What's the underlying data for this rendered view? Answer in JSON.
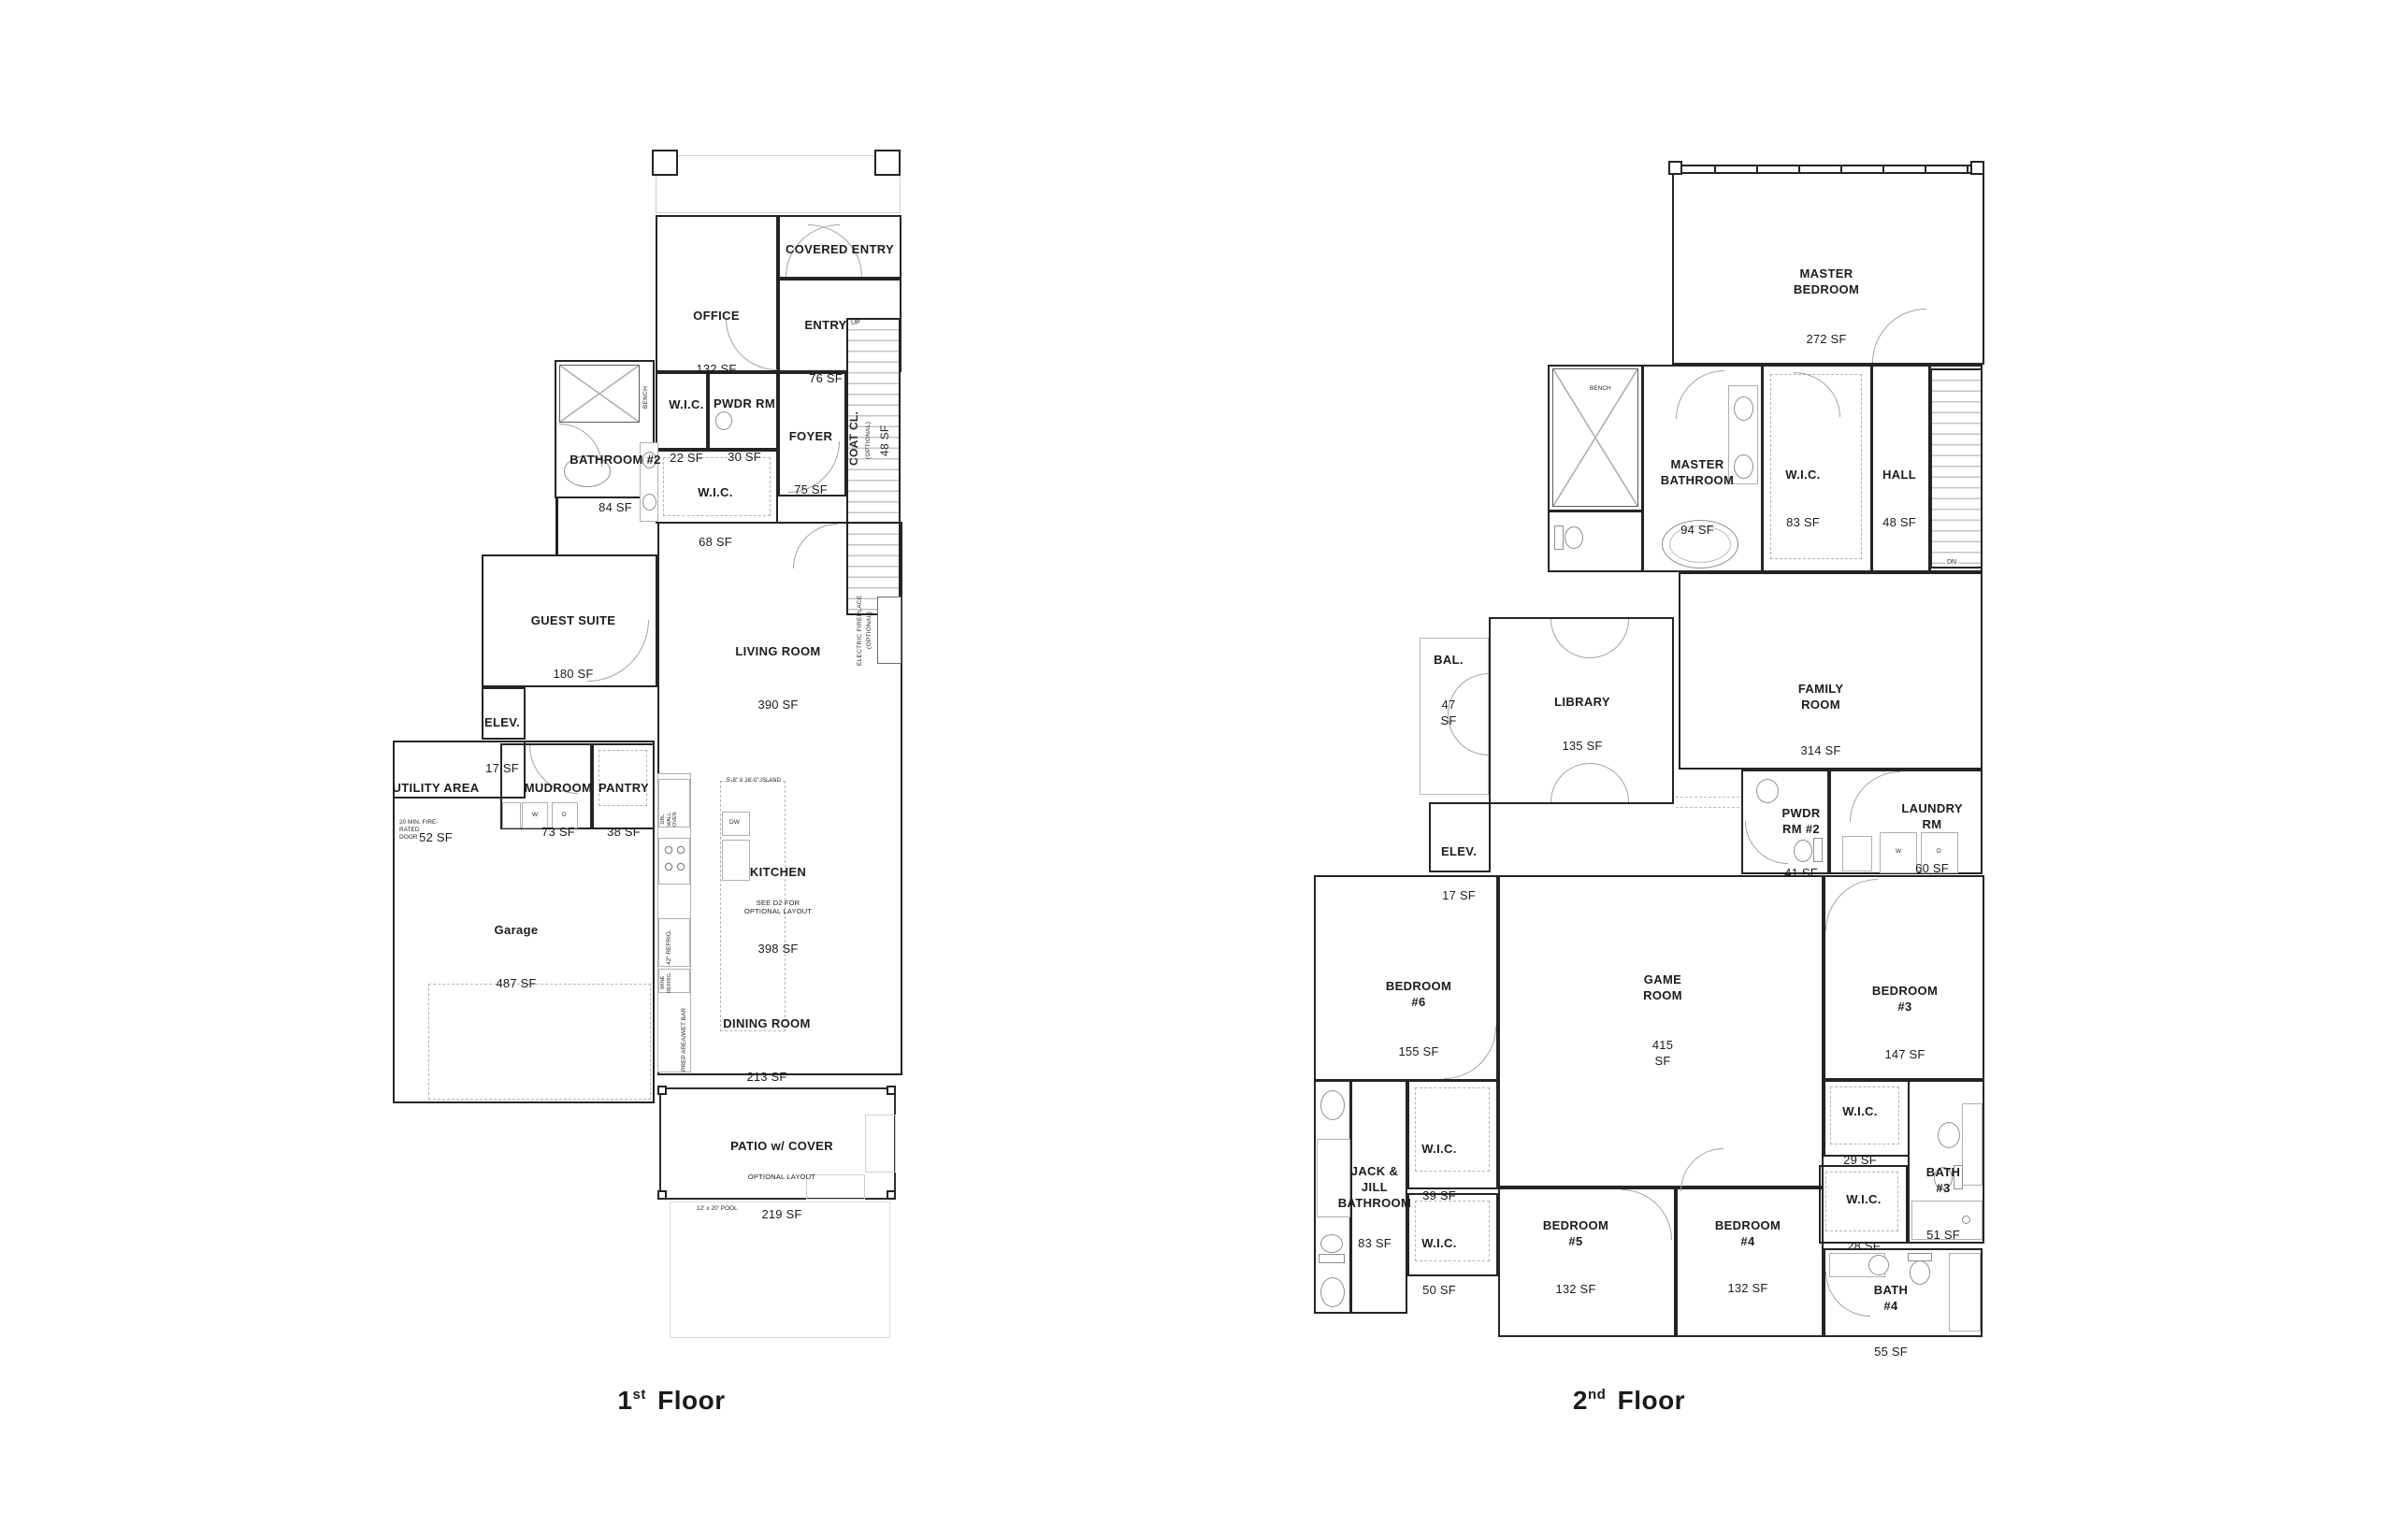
{
  "floors": {
    "first": {
      "title": {
        "num": "1",
        "sup": "st",
        "rest": "Floor"
      },
      "rooms": {
        "office": {
          "name": "OFFICE",
          "area": "132 SF"
        },
        "covered_entry": {
          "name": "COVERED ENTRY"
        },
        "entry": {
          "name": "ENTRY",
          "area": "76 SF"
        },
        "wic_entry": {
          "name": "W.I.C.",
          "area": "22 SF"
        },
        "pwdr": {
          "name": "PWDR RM",
          "area": "30 SF"
        },
        "foyer": {
          "name": "FOYER",
          "area": "75 SF"
        },
        "coat_closet": {
          "name": "COAT CL.",
          "sub": "(OPTIONAL)",
          "area": "48 SF"
        },
        "bathroom2": {
          "name": "BATHROOM #2",
          "area": "84 SF"
        },
        "wic_hall": {
          "name": "W.I.C.",
          "area": "68 SF"
        },
        "guest_suite": {
          "name": "GUEST SUITE",
          "area": "180 SF"
        },
        "living_room": {
          "name": "LIVING ROOM",
          "area": "390 SF"
        },
        "elevator": {
          "name": "ELEV.",
          "area": "17 SF"
        },
        "utility": {
          "name": "UTILITY AREA",
          "area": "52 SF",
          "note": "20 MIN. FIRE-\nRATED\nDOOR"
        },
        "mudroom": {
          "name": "MUDROOM",
          "area": "73 SF"
        },
        "pantry": {
          "name": "PANTRY",
          "area": "38 SF"
        },
        "garage": {
          "name": "Garage",
          "area": "487 SF"
        },
        "kitchen": {
          "name": "KITCHEN",
          "sub": "SEE D2 FOR\nOPTIONAL LAYOUT",
          "area": "398 SF"
        },
        "dining_room": {
          "name": "DINING ROOM",
          "area": "213 SF"
        },
        "patio": {
          "name": "PATIO w/ COVER",
          "sub": "OPTIONAL LAYOUT",
          "area": "219 SF"
        }
      },
      "annotations": {
        "up": "UP",
        "bench": "BENCH",
        "island": "5'-8\" X 16'-0\" ISLAND",
        "dw": "DW",
        "wall_oven": "DBL\nWALL\nOVEN",
        "refrig": "42\" REFRIG.",
        "wine_refrig": "WINE\nREFRIG.",
        "prep_bar": "PREP AREA/WET BAR",
        "fireplace1": "ELECTRIC FIREPLACE",
        "fireplace2": "(OPTIONAL)",
        "washer": "W",
        "dryer": "D",
        "pool": "12' x 20' POOL"
      }
    },
    "second": {
      "title": {
        "num": "2",
        "sup": "nd",
        "rest": "Floor"
      },
      "rooms": {
        "master_bedroom": {
          "name": "MASTER\nBEDROOM",
          "area": "272 SF"
        },
        "master_bathroom": {
          "name": "MASTER\nBATHROOM",
          "area": "94 SF"
        },
        "wic_master": {
          "name": "W.I.C.",
          "area": "83 SF"
        },
        "hall": {
          "name": "HALL",
          "area": "48 SF"
        },
        "balcony": {
          "name": "BAL.",
          "area": "47 SF"
        },
        "library": {
          "name": "LIBRARY",
          "area": "135 SF"
        },
        "family_room": {
          "name": "FAMILY ROOM",
          "area": "314 SF"
        },
        "elevator": {
          "name": "ELEV.",
          "area": "17 SF"
        },
        "pwdr2": {
          "name": "PWDR RM #2",
          "area": "41 SF"
        },
        "laundry": {
          "name": "LAUNDRY RM",
          "area": "60 SF"
        },
        "bedroom6": {
          "name": "BEDROOM #6",
          "area": "155 SF"
        },
        "game_room": {
          "name": "GAME ROOM",
          "area": "415 SF"
        },
        "bedroom3": {
          "name": "BEDROOM #3",
          "area": "147 SF"
        },
        "jack_jill": {
          "name": "JACK & JILL\nBATHROOM",
          "area": "83 SF"
        },
        "wic39": {
          "name": "W.I.C.",
          "area": "39 SF"
        },
        "wic50": {
          "name": "W.I.C.",
          "area": "50 SF"
        },
        "wic29": {
          "name": "W.I.C.",
          "area": "29 SF"
        },
        "wic28": {
          "name": "W.I.C.",
          "area": "28 SF"
        },
        "bedroom5": {
          "name": "BEDROOM #5",
          "area": "132 SF"
        },
        "bedroom4": {
          "name": "BEDROOM #4",
          "area": "132 SF"
        },
        "bath3": {
          "name": "BATH #3",
          "area": "51 SF"
        },
        "bath4": {
          "name": "BATH #4",
          "area": "55 SF"
        }
      },
      "annotations": {
        "bench": "BENCH",
        "dn": "DN",
        "washer": "W",
        "dryer": "D"
      }
    }
  }
}
